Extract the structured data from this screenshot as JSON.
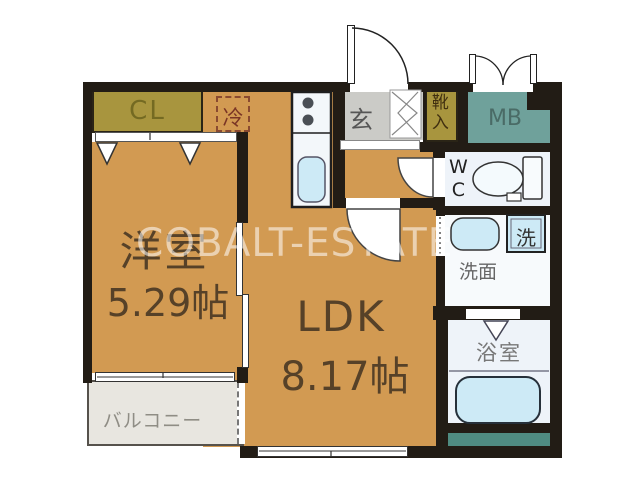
{
  "floorplan": {
    "watermark": "COBALT-ESTATE",
    "western_room": {
      "label": "洋室",
      "size": "5.29帖"
    },
    "ldk": {
      "label": "LDK",
      "size": "8.17帖"
    },
    "balcony": {
      "label": "バルコニー"
    },
    "closet": {
      "label": "CL"
    },
    "refrigerator_space": {
      "label": "冷"
    },
    "entrance": {
      "label": "玄"
    },
    "shoe_cabinet": {
      "label": "靴入"
    },
    "meter_box": {
      "label": "MB"
    },
    "toilet_room": {
      "label": "WC"
    },
    "washing_machine": {
      "label": "洗"
    },
    "washroom": {
      "label": "洗面"
    },
    "bathroom": {
      "label": "浴室"
    },
    "colors": {
      "floor": "#d29a52",
      "wall": "#221c15",
      "closet_fill": "#a8953e",
      "meter_box_fill": "#6fa19b",
      "service_teal": "#4f8b81",
      "entrance_gray": "#cbcbc7",
      "balcony_gray": "#e8e6e0",
      "wet_room_fill": "#eef3f9",
      "fixture_blue": "#cdeaf6",
      "label_brown": "#564128",
      "refrigerator_dash": "#8a4a30"
    }
  }
}
